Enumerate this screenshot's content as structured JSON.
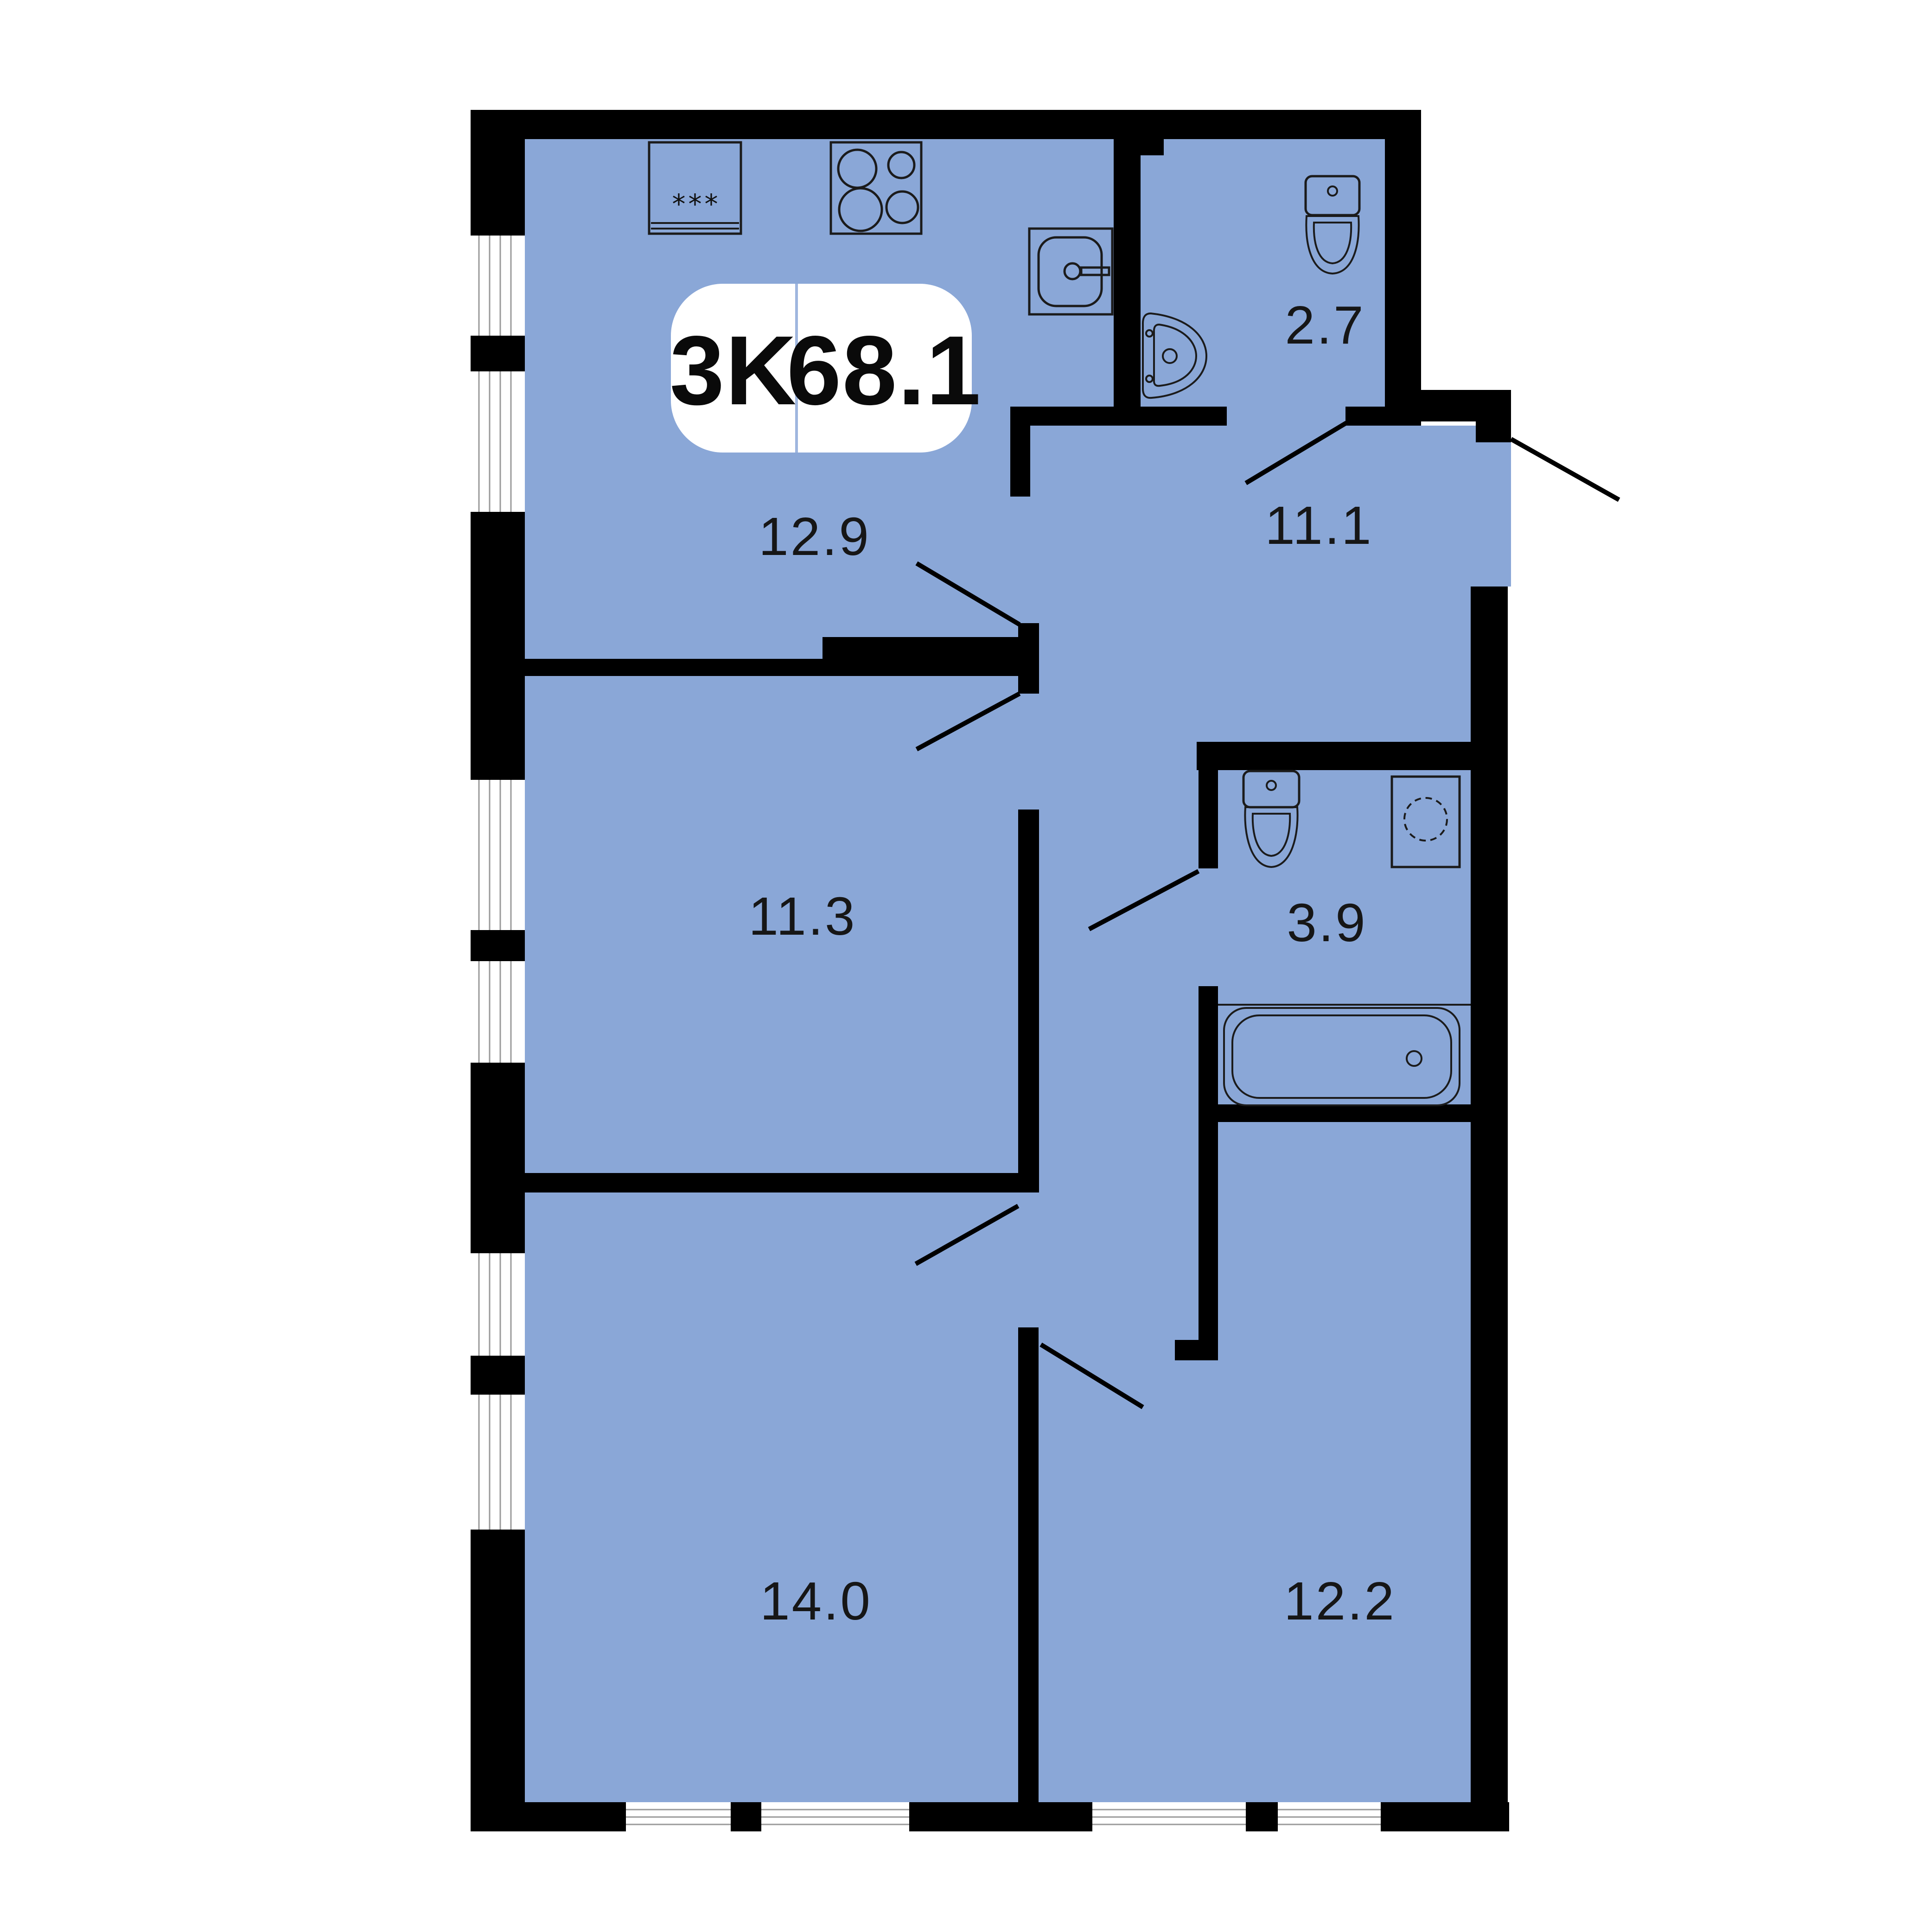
{
  "plan": {
    "badge": {
      "rooms_label": "3K",
      "total_area_label": "68.1"
    },
    "rooms": {
      "kitchen": {
        "name": "kitchen",
        "area": "12.9"
      },
      "hallway": {
        "name": "hallway",
        "area": "11.1"
      },
      "wc": {
        "name": "wc",
        "area": "2.7"
      },
      "bedroom1": {
        "name": "bedroom-1",
        "area": "11.3"
      },
      "bathroom": {
        "name": "bathroom",
        "area": "3.9"
      },
      "living": {
        "name": "living-room",
        "area": "14.0"
      },
      "bedroom2": {
        "name": "bedroom-2",
        "area": "12.2"
      }
    },
    "fixtures": [
      "fridge-icon",
      "stove-icon",
      "kitchen-sink-icon",
      "washbasin-icon",
      "toilet-icon",
      "toilet-icon",
      "washing-machine-icon",
      "bathtub-icon"
    ],
    "colors": {
      "floor": "#8AA7D7",
      "wall": "#000000",
      "label": "#161616",
      "badge_bg": "#FFFFFF",
      "badge_divider": "#9FB6DE",
      "window_line": "#9A9A9A"
    },
    "fridge_stars": "***"
  }
}
